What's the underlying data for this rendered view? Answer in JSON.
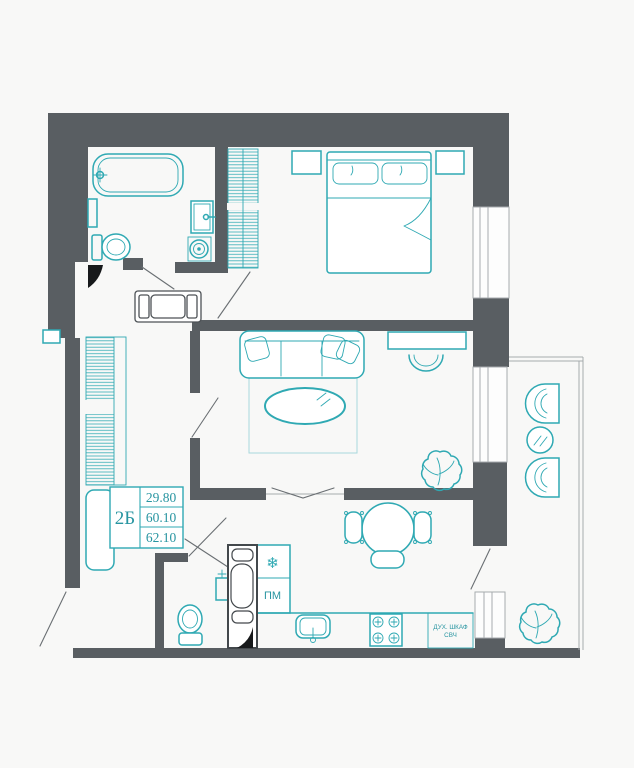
{
  "unit": {
    "label": "2Б",
    "areas": [
      "29.80",
      "60.10",
      "62.10"
    ]
  },
  "kitchen": {
    "dishwasher_label": "ПМ",
    "oven_label_line1": "ДУХ. ШКАФ",
    "oven_label_line2": "СВЧ",
    "fridge_icon": "❄"
  },
  "colors": {
    "background": "#f8f8f7",
    "wall": "#595e62",
    "furniture_accent": "#2fa9b3",
    "label_text": "#2895a1",
    "window_frame": "#a6abae"
  }
}
